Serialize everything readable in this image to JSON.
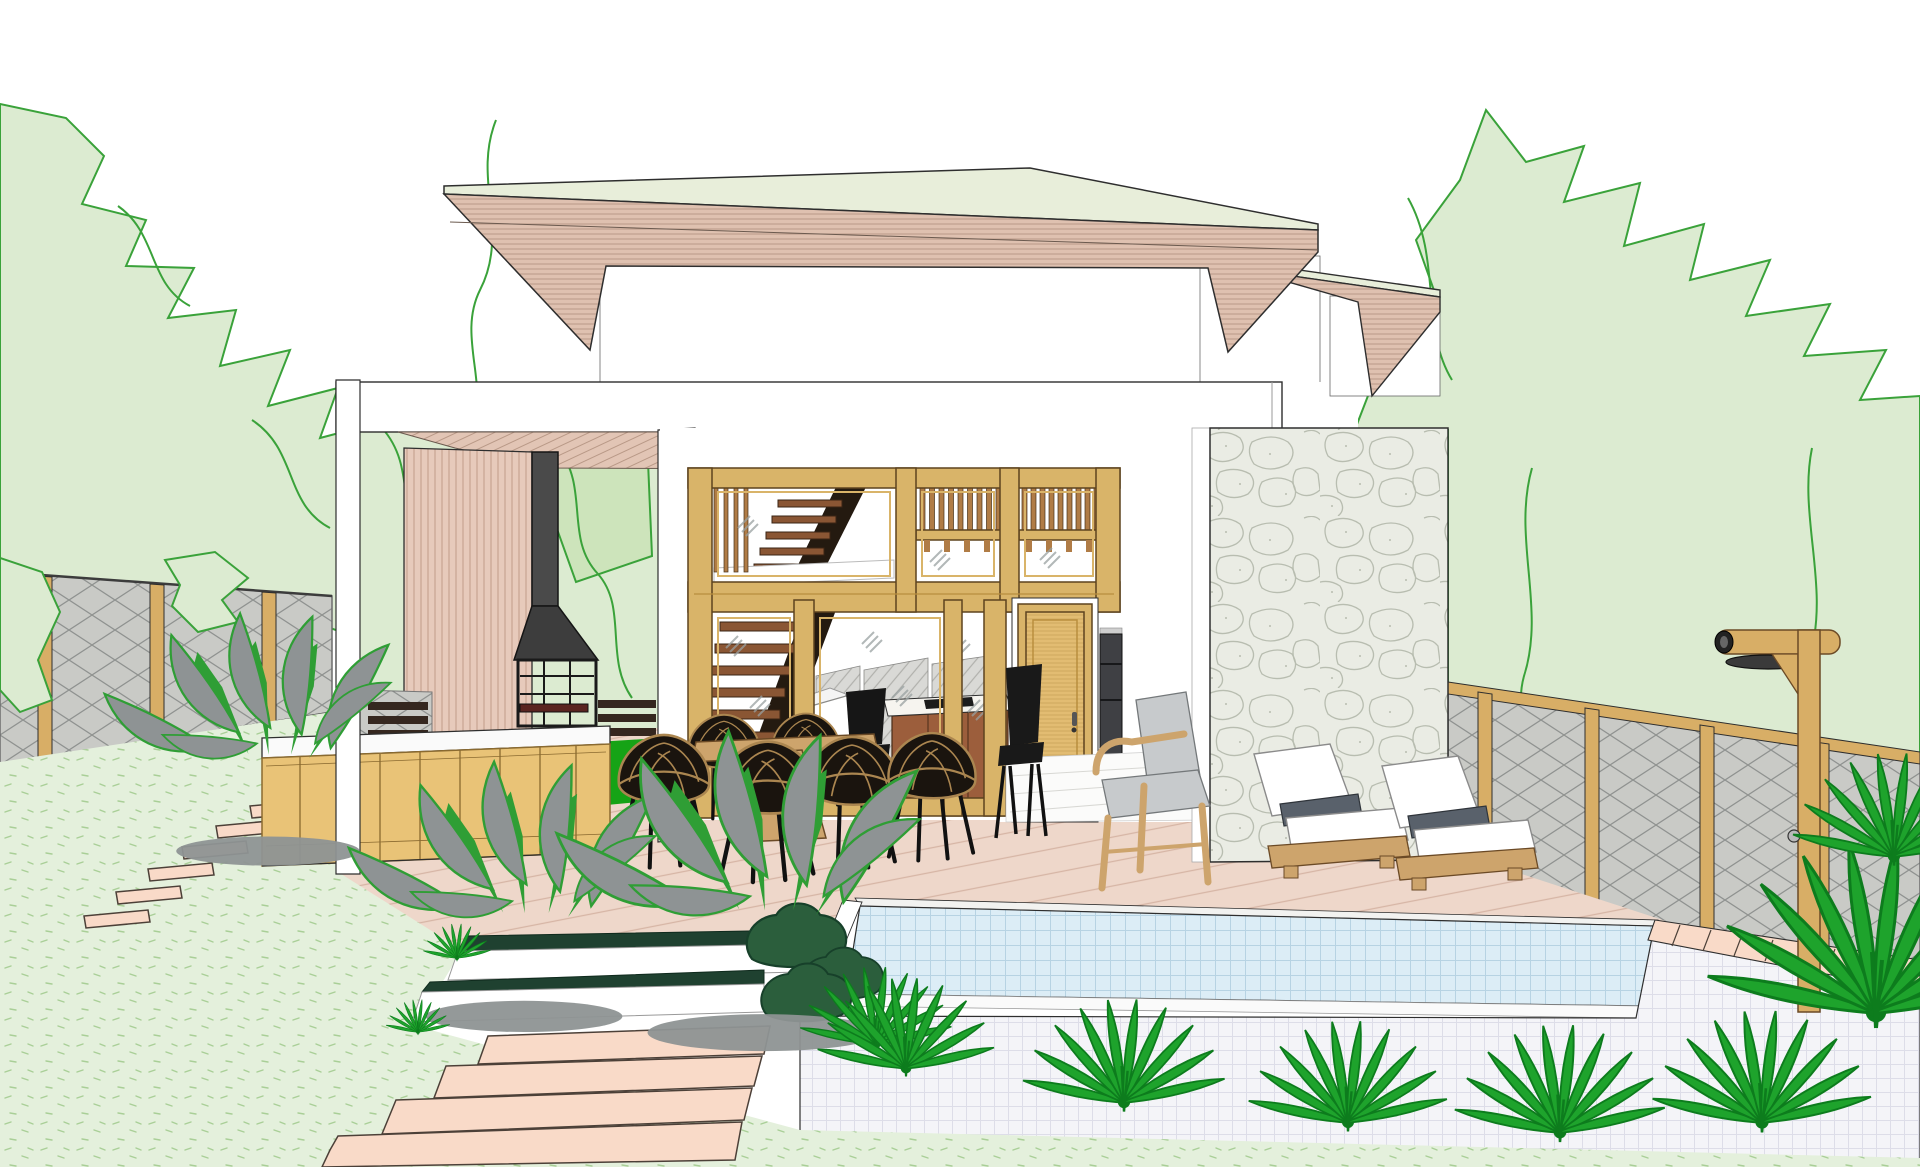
{
  "meta": {
    "title": "Modern two-story tropical villa with glass facade, wooden deck, outdoor kitchen and raised tiled pool — SketchUp-style architectural sketch rendering",
    "medium": "3D architectural line illustration",
    "view": "front exterior perspective, daytime, white sky",
    "canvas": {
      "width": 1920,
      "height": 1167
    }
  },
  "colors": {
    "sky": "#ffffff",
    "ink": "#2e2e2e",
    "tree_fill": "#dcebd1",
    "tree_fill2": "#cde4bb",
    "tree_stroke": "#3aa23a",
    "lawn": "#e4f0dc",
    "lawn_speckle": "#a9cf97",
    "grass_bright": "#16a316",
    "fence_panel": "#c9cac6",
    "fence_line": "#8f9290",
    "wood_post": "#d8ae66",
    "rooftop": "#e8eeda",
    "fascia": "#dfc1b0",
    "fascia_line": "#b99987",
    "soffit": "#e2c5b5",
    "slat": "#e7cabb",
    "slat_line": "#c7a492",
    "wall_white": "#ffffff",
    "chimney": "#4a4a4a",
    "hood": "#3d3d3d",
    "counter_top": "#fafafa",
    "cabinet": "#e9c377",
    "cabinet_line": "#8a6a30",
    "frame_gold": "#d9b469",
    "frame_line": "#5d431f",
    "baluster": "#b07c46",
    "stair_tread": "#8a5634",
    "stringer": "#241a10",
    "glass_streak": "#98a0a0",
    "door": "#e2bc72",
    "stone_fill": "#eaece4",
    "stone_line": "#b8bdb0",
    "deck": "#eed7ca",
    "deck_line": "#d6b5a5",
    "step_tread": "#1f4130",
    "riser": "#ffffff",
    "path_stone": "#f9dac8",
    "pool_water": "#dcedf6",
    "pool_water_line": "#b7d3e3",
    "pool_tile": "#f4f4f8",
    "pool_tile_line": "#dddde8",
    "lounge_cushion": "#ffffff",
    "lounge_bolster": "#59616b",
    "furniture_wood": "#cda46c",
    "rattan_dark": "#1a140e",
    "rattan_trim": "#ab8650",
    "gray_plant": "#8e9394",
    "plant_green": "#2f9e35",
    "palm": "#1ea32c",
    "palm_dark": "#0d7c1d",
    "bush_dark": "#2b5e3c",
    "desk_wood": "#9c5e3c",
    "back_fence": "#d9d9d6"
  },
  "scene": {
    "vegetation": {
      "left_trees": "light-green outlined tree mass",
      "right_trees": "light-green outlined tree mass",
      "gray_plants": "3 gray broad-leaf plant clusters with green outlines and gray ground shadows",
      "palms": "bright green fan palms along pool front and right fence",
      "dark_bushes": "dark green shrubs at pool left corner"
    },
    "house": {
      "roof": {
        "main": "hip roof, pale green top, pink horizontal-board fascia",
        "secondary": "smaller matching roof behind right"
      },
      "upper_wall": "white second-storey wall",
      "canopy": "white flat terrace canopy with pink hatched soffit and white left column",
      "facade": {
        "frames": "golden timber window wall, two bands",
        "upper_band": "mezzanine balcony with wooden balusters and glass",
        "lower_band": "sliding glass doors, interior visible",
        "stairs": "wooden open-tread stair behind glass"
      },
      "door": "timber entry door with dark handle",
      "appliance": "dark built-in oven tower",
      "stone_wall": "large rubble-stone clad wall on right",
      "slat_wall": "pink vertical-slat wall behind outdoor kitchen"
    },
    "outdoor_kitchen": {
      "chimney": "black chimney and hood over open grill",
      "counter": "white countertop on timber cabinets"
    },
    "terrace": {
      "deck": "pink timber deck with diagonal boards and two dark-green/white steps",
      "dining_set": {
        "table": "round timber pedestal table",
        "chairs": "6 black rattan bowl chairs"
      },
      "armchair": "grey cushioned timber armchair",
      "lounge_chairs": "2 white sun loungers with dark grey bolsters on timber bases",
      "shower": "timber outdoor shower post with round head and valve"
    },
    "pool": {
      "water": "light blue mosaic water",
      "wall": "white tiled raised pool wall",
      "coping": "pink stone coping on right rim"
    },
    "garden": {
      "lawn": "speckled light green lawn",
      "stepping_stones": "wide pink stepping-stone path lower left plus small stone run to side gate",
      "fences": "grey diamond-lattice fence with timber posts, left and right",
      "back_view": "lattice fence and bright grass seen through house gaps"
    }
  }
}
